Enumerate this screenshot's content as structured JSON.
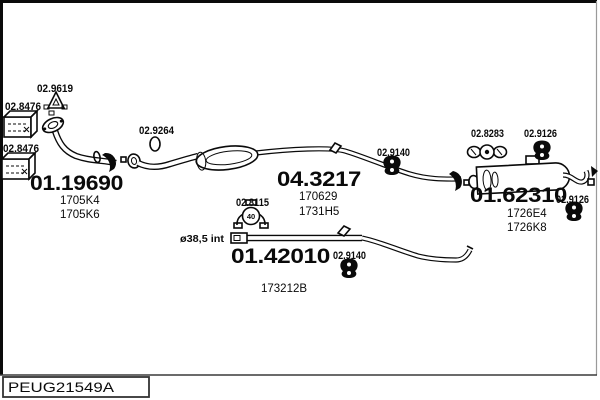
{
  "plate": {
    "code": "PEUG21549A"
  },
  "colors": {
    "ink": "#0a0a0a",
    "background": "#ffffff"
  },
  "parts": {
    "front_pipe": {
      "code": "01.19690",
      "refs": [
        "1705K4",
        "1705K6"
      ]
    },
    "center_section": {
      "code": "04.3217",
      "refs": [
        "170629",
        "1731H5"
      ]
    },
    "lower_pipe": {
      "code": "01.42010",
      "note": "ø38,5 int",
      "refs": [
        "173212B"
      ]
    },
    "rear_silencer": {
      "code": "01.62310",
      "refs": [
        "1726E4",
        "1726K8"
      ]
    }
  },
  "fittings": {
    "gasket_triangle": {
      "code": "02.9619"
    },
    "bracket_upper": {
      "code": "02.8476"
    },
    "bracket_lower": {
      "code": "02.8476"
    },
    "oring": {
      "code": "02.9264"
    },
    "clamp_mid": {
      "code": "02.8115",
      "size_label": "40"
    },
    "hanger_pipe_upper": {
      "code": "02.9140"
    },
    "hanger_pipe_lower": {
      "code": "02.9140"
    },
    "clamp_rear": {
      "code": "02.8283"
    },
    "hanger_rear_top": {
      "code": "02.9126"
    },
    "hanger_rear_end": {
      "code": "02.9126"
    }
  }
}
